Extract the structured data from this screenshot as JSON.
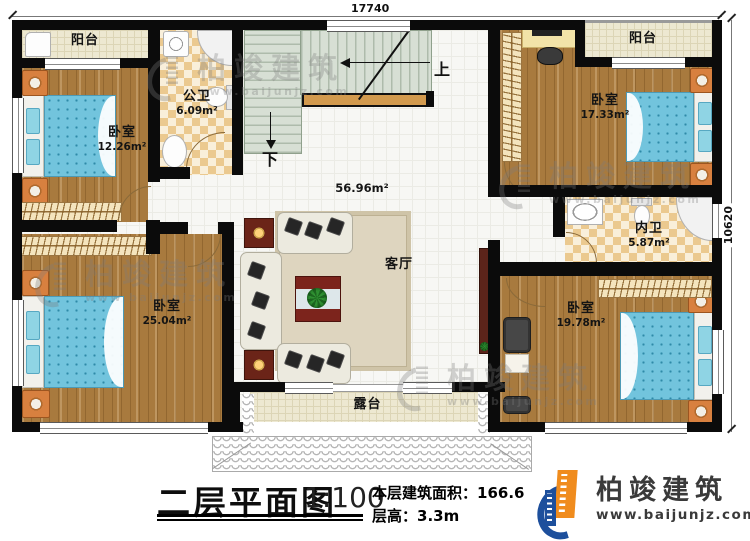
{
  "dimensions": {
    "top": "17740",
    "right": "10620"
  },
  "rooms": {
    "balcony_tl": {
      "name": "阳台"
    },
    "bedroom_tl": {
      "name": "卧室",
      "area": "12.26m²"
    },
    "bath_public": {
      "name": "公卫",
      "area": "6.09m²"
    },
    "bedroom_tr": {
      "name": "卧室",
      "area": "17.33m²"
    },
    "balcony_tr": {
      "name": "阳台"
    },
    "bath_ensuite": {
      "name": "内卫",
      "area": "5.87m²"
    },
    "bedroom_br": {
      "name": "卧室",
      "area": "19.78m²"
    },
    "bedroom_bl": {
      "name": "卧室",
      "area": "25.04m²"
    },
    "living": {
      "name": "客厅",
      "area": "56.96m²"
    },
    "terrace": {
      "name": "露台"
    },
    "stairs": {
      "up_label": "上",
      "down_label": "下"
    }
  },
  "title_block": {
    "title": "二层平面图",
    "scale": "1:100",
    "floor_area_label": "本层建筑面积：",
    "floor_area_value": "166.6",
    "floor_height_label": "层高：",
    "floor_height_value": "3.3m"
  },
  "logo": {
    "name": "柏竣建筑",
    "url": "www.baijunjz.com"
  },
  "watermark": {
    "text": "柏竣建筑",
    "url": "www.baijunjz.com"
  },
  "colors": {
    "wall": "#0b0b0b",
    "wood_floor": "#a87a3e",
    "tile_cream": "#ede8d1",
    "tile_checker": "#ebc98f",
    "bed_blue": "#72c4dd",
    "nightstand_orange": "#d8803f",
    "stair_green": "#d7dfd4",
    "logo_blue": "#1d4f9c",
    "logo_orange": "#f08c1e",
    "watermark_gray": "#7d7d7d"
  }
}
